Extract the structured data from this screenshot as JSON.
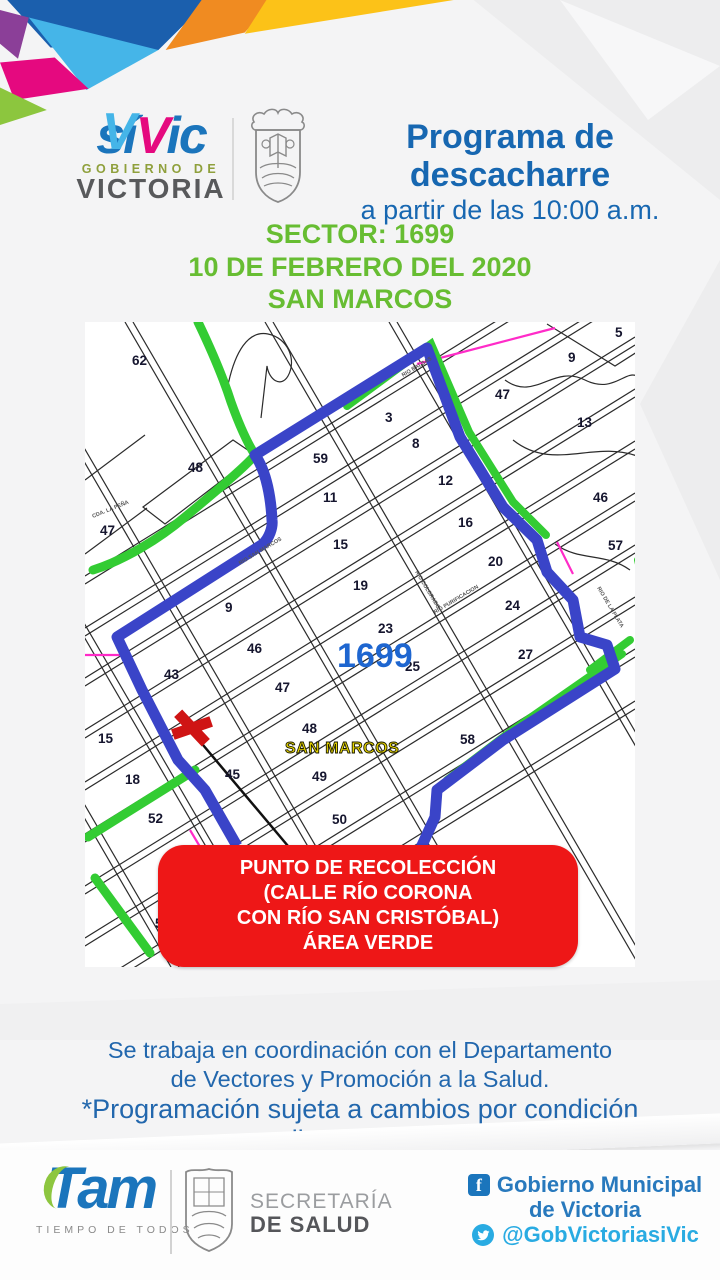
{
  "colors": {
    "brand_blue": "#1b75bc",
    "header_blue": "#1767b1",
    "announce_green": "#67bd32",
    "map_boundary_blue": "#3a44c8",
    "map_street_green": "#33cc33",
    "map_rail_magenta": "#ff2bc8",
    "callout_red": "#ee1717",
    "map_sector_blue": "#1e66d0",
    "map_colonia_yellow": "#e8d600",
    "twitter_blue": "#29abe2",
    "logo_magenta": "#e5097f",
    "logo_cyan": "#45b5e8"
  },
  "header": {
    "logo": {
      "si": "sí",
      "v": "V",
      "ic": "ic",
      "subtitle": "GOBIERNO DE",
      "city": "VICTORIA"
    },
    "crest": "victoria-coat-of-arms",
    "title": "Programa de descacharre",
    "subtitle": "a partir de las 10:00 a.m."
  },
  "announcement": {
    "sector": "SECTOR: 1699",
    "date": "10 DE FEBRERO DEL 2020",
    "colonia": "SAN MARCOS"
  },
  "map": {
    "sector_label": {
      "text": "1699",
      "x": 252,
      "y": 345
    },
    "colonia_label": {
      "text": "SAN MARCOS",
      "x": 200,
      "y": 431
    },
    "marker": {
      "x": 107,
      "y": 406,
      "angle": 14
    },
    "blocks": [
      {
        "n": "62",
        "x": 47,
        "y": 43
      },
      {
        "n": "48",
        "x": 103,
        "y": 150
      },
      {
        "n": "59",
        "x": 228,
        "y": 141
      },
      {
        "n": "11",
        "x": 238,
        "y": 180
      },
      {
        "n": "47",
        "x": 15,
        "y": 213
      },
      {
        "n": "3",
        "x": 300,
        "y": 100
      },
      {
        "n": "8",
        "x": 327,
        "y": 126
      },
      {
        "n": "12",
        "x": 353,
        "y": 163
      },
      {
        "n": "16",
        "x": 373,
        "y": 205
      },
      {
        "n": "5",
        "x": 530,
        "y": 15
      },
      {
        "n": "9",
        "x": 483,
        "y": 40
      },
      {
        "n": "47",
        "x": 410,
        "y": 77
      },
      {
        "n": "13",
        "x": 492,
        "y": 105
      },
      {
        "n": "46",
        "x": 508,
        "y": 180
      },
      {
        "n": "57",
        "x": 523,
        "y": 228
      },
      {
        "n": "15",
        "x": 248,
        "y": 227
      },
      {
        "n": "19",
        "x": 268,
        "y": 268
      },
      {
        "n": "9",
        "x": 140,
        "y": 290
      },
      {
        "n": "46",
        "x": 162,
        "y": 331
      },
      {
        "n": "43",
        "x": 79,
        "y": 357
      },
      {
        "n": "47",
        "x": 190,
        "y": 370
      },
      {
        "n": "20",
        "x": 403,
        "y": 244
      },
      {
        "n": "24",
        "x": 420,
        "y": 288
      },
      {
        "n": "23",
        "x": 293,
        "y": 311
      },
      {
        "n": "25",
        "x": 320,
        "y": 349
      },
      {
        "n": "27",
        "x": 433,
        "y": 337
      },
      {
        "n": "15",
        "x": 13,
        "y": 421
      },
      {
        "n": "48",
        "x": 217,
        "y": 411
      },
      {
        "n": "58",
        "x": 375,
        "y": 422
      },
      {
        "n": "18",
        "x": 40,
        "y": 462
      },
      {
        "n": "45",
        "x": 140,
        "y": 457
      },
      {
        "n": "49",
        "x": 227,
        "y": 459
      },
      {
        "n": "52",
        "x": 63,
        "y": 501
      },
      {
        "n": "50",
        "x": 247,
        "y": 502
      },
      {
        "n": "5",
        "x": 70,
        "y": 606
      }
    ],
    "street_labels": [
      {
        "text": "RIO SAN MARCOS",
        "x": 155,
        "y": 243,
        "angle": -31
      },
      {
        "text": "RIO BALSAS",
        "x": 318,
        "y": 55,
        "angle": -31
      },
      {
        "text": "RIO COLORADO",
        "x": 330,
        "y": 250,
        "angle": 59
      },
      {
        "text": "RIO PURIFICACION",
        "x": 350,
        "y": 292,
        "angle": -31
      },
      {
        "text": "RIO DE LA PLATA",
        "x": 512,
        "y": 266,
        "angle": 59
      },
      {
        "text": "CDA. LA PEÑA",
        "x": 8,
        "y": 196,
        "angle": -22
      }
    ]
  },
  "callout": {
    "line1": "PUNTO DE RECOLECCIÓN",
    "line2": "(CALLE RÍO CORONA",
    "line3": "CON RÍO SAN CRISTÓBAL)",
    "line4": "ÁREA VERDE"
  },
  "coordination": {
    "line1": "Se trabaja en coordinación con el Departamento",
    "line2": "de Vectores y Promoción a la Salud."
  },
  "disclaimer": "*Programación sujeta a cambios por condición climatológica.",
  "footer": {
    "tam": {
      "brand": "Tam",
      "tagline": "TIEMPO DE TODOS"
    },
    "health": {
      "line1": "SECRETARÍA",
      "line2": "DE SALUD"
    },
    "social": {
      "facebook_line1": "Gobierno Municipal",
      "facebook_line2": "de Victoria",
      "twitter_handle": "@GobVictoriasiVic"
    }
  }
}
